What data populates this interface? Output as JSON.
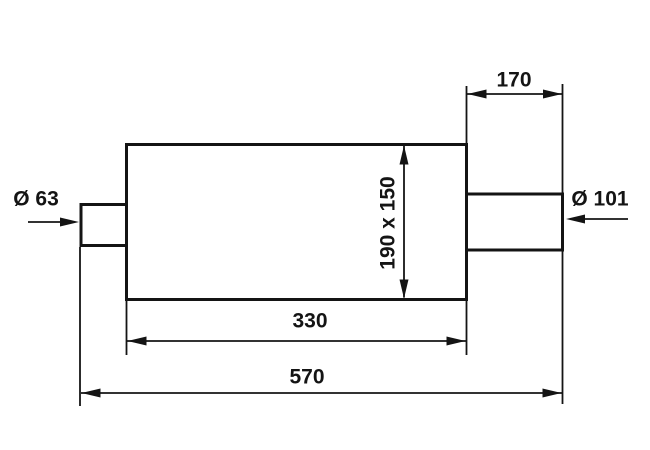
{
  "drawing": {
    "type": "technical-dimension-drawing",
    "background_color": "#ffffff",
    "line_color": "#141414",
    "labels": {
      "outlet_pipe_length": "170",
      "body_cross_section": "190 x 150",
      "body_length": "330",
      "overall_length": "570",
      "inlet_diameter": "Ø 63",
      "outlet_diameter": "Ø 101"
    }
  }
}
